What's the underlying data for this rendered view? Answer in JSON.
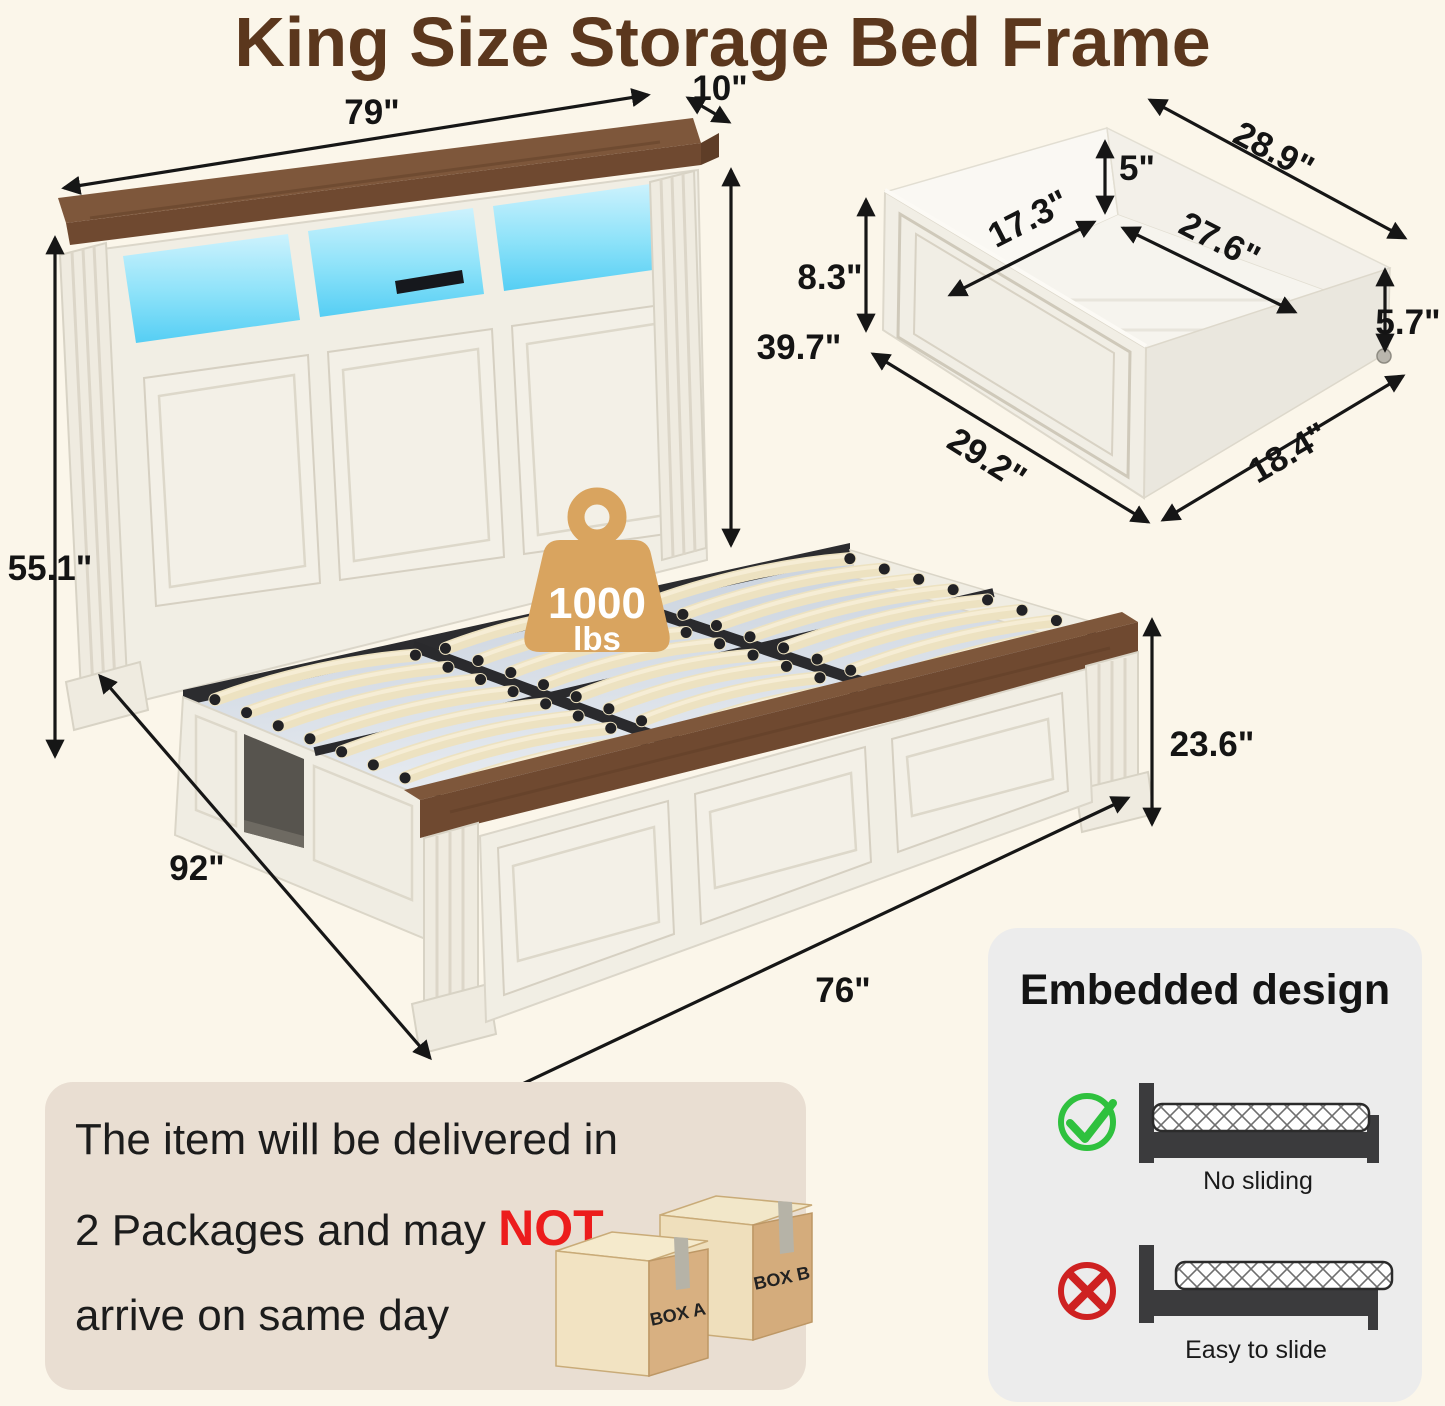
{
  "title": "King Size Storage Bed Frame",
  "colors": {
    "background": "#FBF6EA",
    "title_brown": "#5B371D",
    "wood_brown": "#6F4930",
    "led_cyan": "#5FD3F4",
    "badge_tan": "#D9A45F",
    "emphasis_red": "#EC1C1C",
    "check_green": "#2FC13E",
    "cross_red": "#CE2121"
  },
  "bed": {
    "weight_badge": {
      "value": "1000",
      "unit": "lbs"
    },
    "dims": {
      "headboard_width": "79\"",
      "headboard_depth": "10\"",
      "headboard_panel_height": "39.7\"",
      "headboard_total_height": "55.1\"",
      "bed_length": "92\"",
      "bed_width": "76\"",
      "footboard_height": "23.6\""
    }
  },
  "drawer": {
    "dims": {
      "front_height": "8.3\"",
      "inner_width": "17.3\"",
      "back_height": "5\"",
      "top_length": "28.9\"",
      "inner_length": "27.6\"",
      "side_height": "5.7\"",
      "front_length": "29.2\"",
      "side_width": "18.4\""
    }
  },
  "delivery": {
    "line1": "The item will be delivered in",
    "line2_prefix": "2 Packages and may ",
    "line2_emphasis": "NOT",
    "line3": "arrive on same day",
    "box_a": "BOX A",
    "box_b": "BOX B"
  },
  "embedded": {
    "title": "Embedded design",
    "good_caption": "No sliding",
    "bad_caption": "Easy to slide"
  }
}
